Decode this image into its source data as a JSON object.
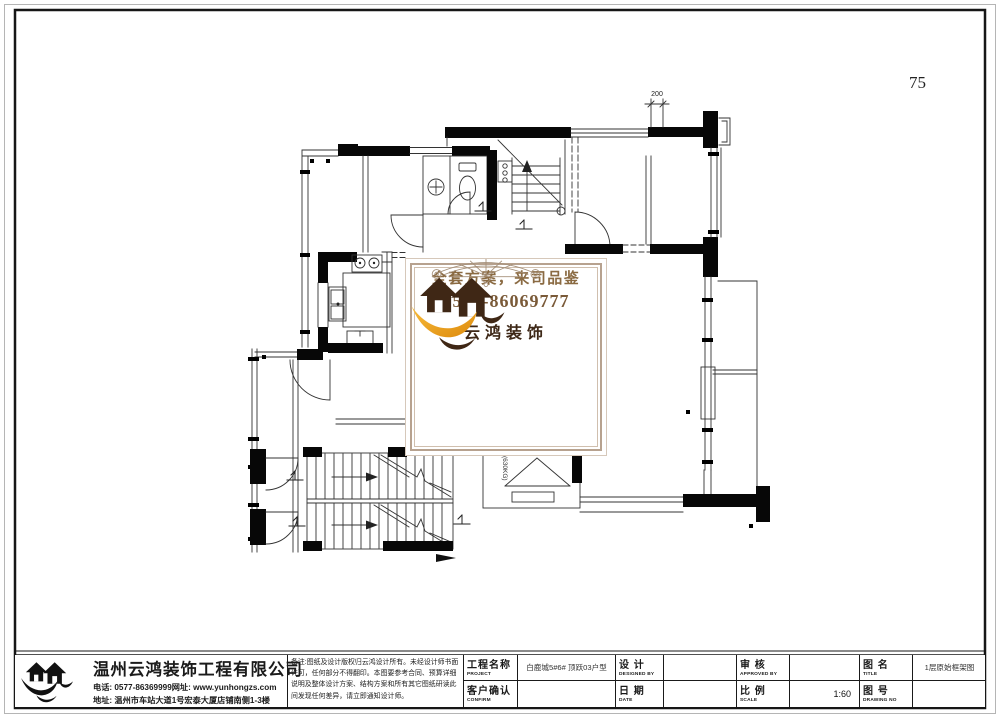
{
  "page": {
    "number": "75"
  },
  "plan": {
    "dim_top": "200",
    "elevator_capacity": "(630KG)"
  },
  "watermark": {
    "slogan": "全套方案，来司品鉴",
    "phone": "0577-86069777",
    "brand": "云鸿装饰",
    "accent_gold": "#efa11c",
    "accent_brown": "#3f2715",
    "text_brown": "#8a6a42"
  },
  "titleblock": {
    "company_name": "温州云鸿装饰工程有限公司",
    "contact_line1": "电话: 0577-86369999网址: www.yunhongzs.com",
    "contact_line2": "地址: 温州市车站大道1号宏泰大厦店铺南侧1-3楼",
    "notes": "备注:图纸及设计版权归云鸿设计所有。未经设计师书面许可，任何部分不得翻印。本图要参考合同、预算详细说明及整体设计方案、结构方案和所有其它图纸研读此间发现任何差异，请立即通知设计师。",
    "fields": {
      "project_label": "工程名称",
      "project_sub": "PROJECT",
      "project_value": "白鹿城5#6# 顶跃03户型",
      "design_label": "设 计",
      "design_sub": "DESIGNED BY",
      "design_value": "",
      "approve_label": "审 核",
      "approve_sub": "APPROVED BY",
      "approve_value": "",
      "title_label": "图 名",
      "title_sub": "TITLE",
      "title_value": "1层原始框架图",
      "confirm_label": "客户确认",
      "confirm_sub": "CONFIRM",
      "confirm_value": "",
      "date_label": "日 期",
      "date_sub": "DATE",
      "date_value": "",
      "scale_label": "比 例",
      "scale_sub": "SCALE",
      "scale_value": "1:60",
      "drawingno_label": "图 号",
      "drawingno_sub": "DRAWING NO",
      "drawingno_value": ""
    }
  }
}
